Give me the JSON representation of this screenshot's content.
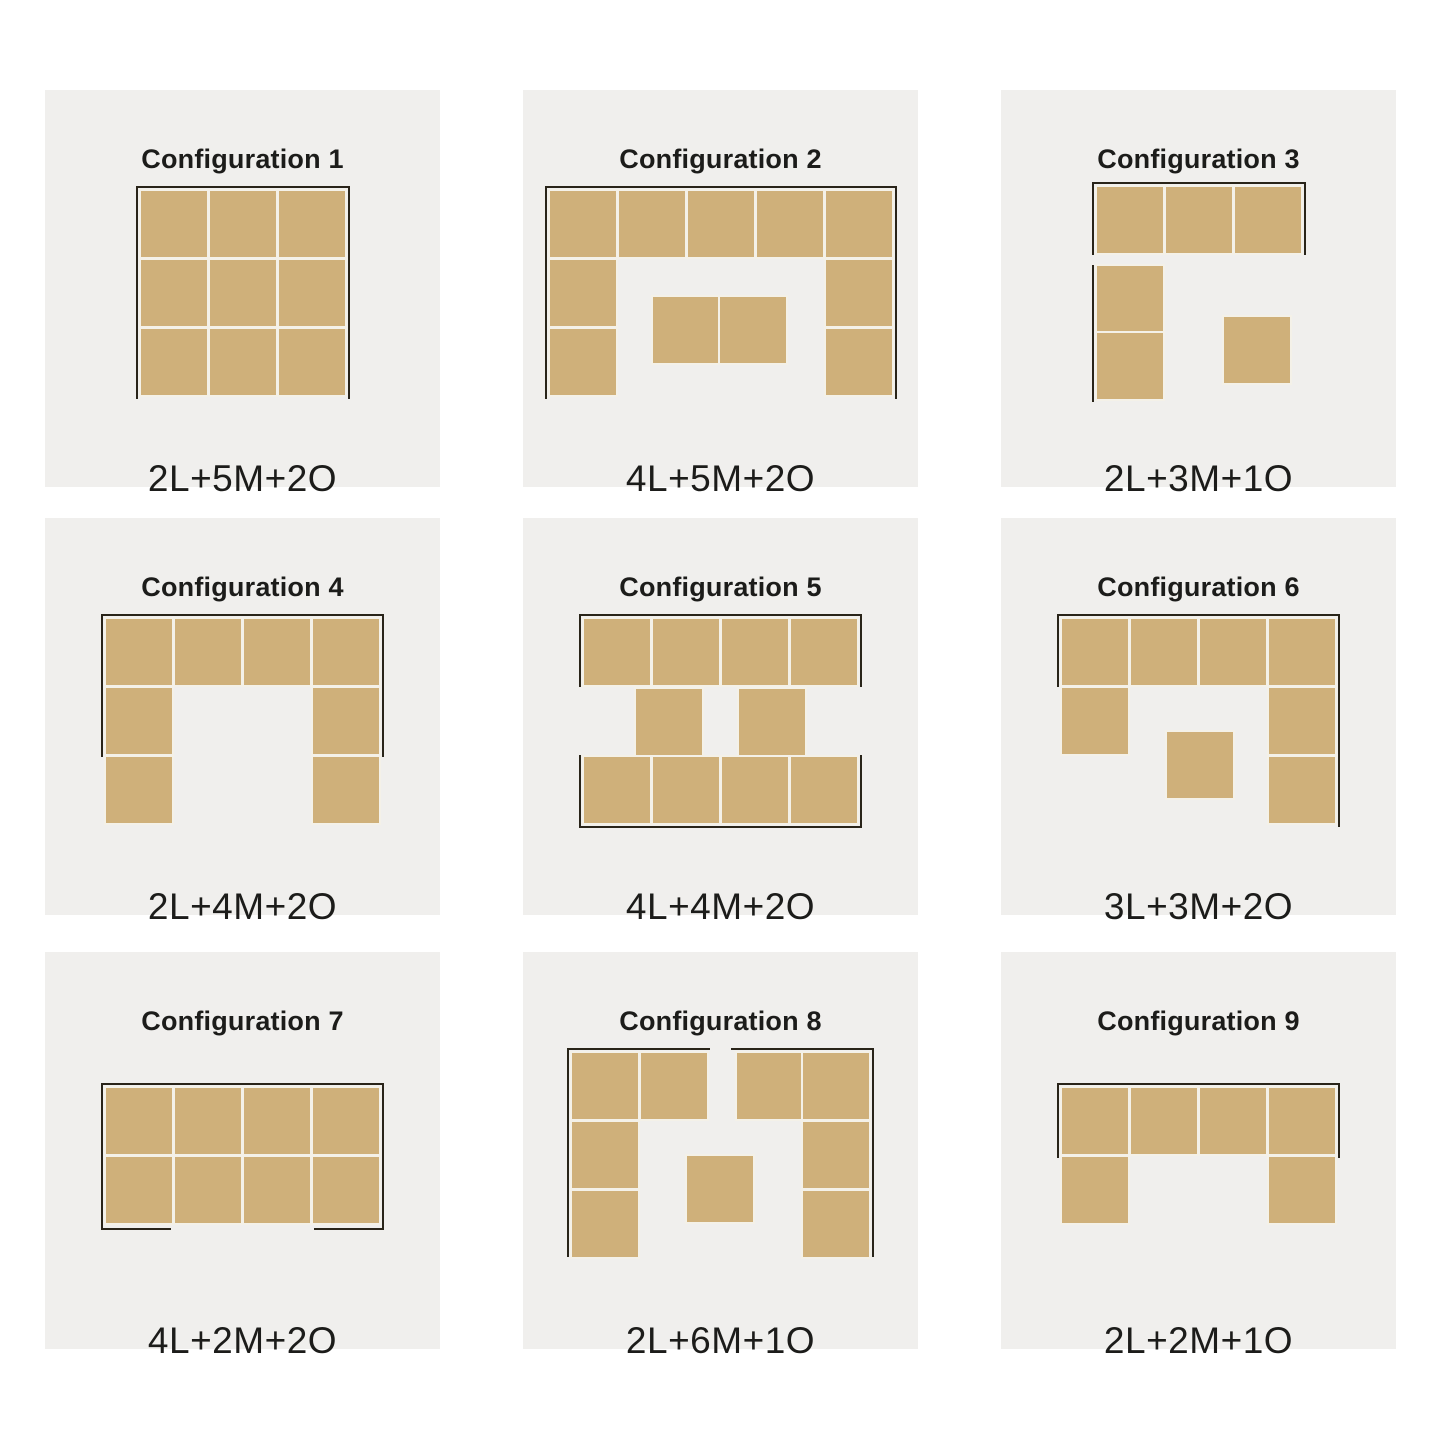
{
  "style": {
    "page_bg": "#ffffff",
    "card_bg": "#f0efed",
    "seat_color": "#cfb07a",
    "halo_color": "#f4f1e8",
    "outline_color": "#292419",
    "text_color": "#1c1c1a"
  },
  "layout": {
    "card_w": 395,
    "card_h": 397,
    "col_x": [
      45,
      523,
      1001
    ],
    "row_y": [
      90,
      518,
      952
    ],
    "unit_pitch": 69,
    "unit_size": 66,
    "diagram_center_y": 203
  },
  "cards": [
    {
      "title": "Configuration 1",
      "label": "2L+5M+2O",
      "diagram": {
        "w": 204,
        "h": 204,
        "seats": [
          [
            0,
            0
          ],
          [
            1,
            0
          ],
          [
            2,
            0
          ],
          [
            0,
            1
          ],
          [
            1,
            1
          ],
          [
            2,
            1
          ],
          [
            0,
            2
          ],
          [
            1,
            2
          ],
          [
            2,
            2
          ]
        ],
        "ottomans": [],
        "frame": [
          [
            -5,
            -5,
            214,
            2
          ],
          [
            -5,
            -5,
            2,
            213
          ],
          [
            207,
            -5,
            2,
            213
          ]
        ]
      }
    },
    {
      "title": "Configuration 2",
      "label": "4L+5M+2O",
      "diagram": {
        "w": 342,
        "h": 204,
        "seats": [
          [
            0,
            0
          ],
          [
            1,
            0
          ],
          [
            2,
            0
          ],
          [
            3,
            0
          ],
          [
            4,
            0
          ],
          [
            0,
            1
          ],
          [
            4,
            1
          ],
          [
            0,
            2
          ],
          [
            4,
            2
          ]
        ],
        "ottomans": [
          [
            1.5,
            1.54
          ],
          [
            2.47,
            1.54
          ]
        ],
        "frame": [
          [
            -5,
            -5,
            352,
            2
          ],
          [
            -5,
            -5,
            2,
            213
          ],
          [
            345,
            -5,
            2,
            213
          ]
        ]
      }
    },
    {
      "title": "Configuration 3",
      "label": "2L+3M+1O",
      "diagram": {
        "w": 204,
        "h": 212,
        "seats": [
          [
            0,
            0
          ],
          [
            1,
            0
          ],
          [
            2,
            0
          ],
          [
            0,
            1.15
          ],
          [
            0,
            2.12
          ]
        ],
        "ottomans": [
          [
            1.85,
            1.88
          ]
        ],
        "frame": [
          [
            -5,
            -5,
            214,
            2
          ],
          [
            -5,
            -5,
            2,
            73
          ],
          [
            207,
            -5,
            2,
            73
          ],
          [
            -5,
            78,
            2,
            137
          ]
        ]
      }
    },
    {
      "title": "Configuration 4",
      "label": "2L+4M+2O",
      "diagram": {
        "w": 273,
        "h": 204,
        "seats": [
          [
            0,
            0
          ],
          [
            1,
            0
          ],
          [
            2,
            0
          ],
          [
            3,
            0
          ],
          [
            0,
            1
          ],
          [
            3,
            1
          ],
          [
            0,
            2
          ],
          [
            3,
            2
          ]
        ],
        "ottomans": [],
        "frame": [
          [
            -5,
            -5,
            283,
            2
          ],
          [
            -5,
            -5,
            2,
            143
          ],
          [
            276,
            -5,
            2,
            143
          ]
        ]
      }
    },
    {
      "title": "Configuration 5",
      "label": "4L+4M+2O",
      "diagram": {
        "w": 273,
        "h": 204,
        "seats": [
          [
            0,
            0
          ],
          [
            1,
            0
          ],
          [
            2,
            0
          ],
          [
            3,
            0
          ],
          [
            0,
            2
          ],
          [
            1,
            2
          ],
          [
            2,
            2
          ],
          [
            3,
            2
          ]
        ],
        "ottomans": [
          [
            0.75,
            1.01
          ],
          [
            2.25,
            1.01
          ]
        ],
        "frame": [
          [
            -5,
            -5,
            283,
            2
          ],
          [
            -5,
            -5,
            2,
            73
          ],
          [
            276,
            -5,
            2,
            73
          ],
          [
            -5,
            207,
            283,
            2
          ],
          [
            -5,
            136,
            2,
            73
          ],
          [
            276,
            136,
            2,
            73
          ]
        ]
      }
    },
    {
      "title": "Configuration 6",
      "label": "3L+3M+2O",
      "diagram": {
        "w": 273,
        "h": 204,
        "seats": [
          [
            0,
            0
          ],
          [
            1,
            0
          ],
          [
            2,
            0
          ],
          [
            3,
            0
          ],
          [
            0,
            1
          ],
          [
            3,
            1
          ],
          [
            3,
            2
          ]
        ],
        "ottomans": [
          [
            1.52,
            1.64
          ]
        ],
        "frame": [
          [
            -5,
            -5,
            283,
            2
          ],
          [
            -5,
            -5,
            2,
            73
          ],
          [
            276,
            -5,
            2,
            213
          ]
        ]
      }
    },
    {
      "title": "Configuration 7",
      "label": "4L+2M+2O",
      "diagram": {
        "w": 273,
        "h": 135,
        "seats": [
          [
            0,
            0
          ],
          [
            1,
            0
          ],
          [
            2,
            0
          ],
          [
            3,
            0
          ],
          [
            0,
            1
          ],
          [
            1,
            1
          ],
          [
            2,
            1
          ],
          [
            3,
            1
          ]
        ],
        "ottomans": [],
        "frame": [
          [
            -5,
            -5,
            283,
            2
          ],
          [
            -5,
            -5,
            2,
            147
          ],
          [
            276,
            -5,
            2,
            147
          ],
          [
            -5,
            140,
            70,
            2
          ],
          [
            208,
            140,
            70,
            2
          ]
        ]
      }
    },
    {
      "title": "Configuration 8",
      "label": "2L+6M+1O",
      "diagram": {
        "w": 297,
        "h": 204,
        "seats": [
          [
            0,
            0
          ],
          [
            1,
            0
          ],
          [
            0,
            1
          ],
          [
            0,
            2
          ],
          [
            2.39,
            0
          ],
          [
            3.35,
            0
          ],
          [
            3.35,
            1
          ],
          [
            3.35,
            2
          ]
        ],
        "ottomans": [
          [
            1.67,
            1.49
          ]
        ],
        "frame": [
          [
            -5,
            -5,
            143,
            2
          ],
          [
            -5,
            -5,
            2,
            209
          ],
          [
            159,
            -5,
            143,
            2
          ],
          [
            300,
            -5,
            2,
            209
          ]
        ]
      }
    },
    {
      "title": "Configuration 9",
      "label": "2L+2M+1O",
      "diagram": {
        "w": 273,
        "h": 135,
        "seats": [
          [
            0,
            0
          ],
          [
            1,
            0
          ],
          [
            2,
            0
          ],
          [
            3,
            0
          ],
          [
            0,
            1
          ],
          [
            3,
            1
          ]
        ],
        "ottomans": [],
        "frame": [
          [
            -5,
            -5,
            283,
            2
          ],
          [
            -5,
            -5,
            2,
            75
          ],
          [
            276,
            -5,
            2,
            75
          ]
        ]
      }
    }
  ]
}
